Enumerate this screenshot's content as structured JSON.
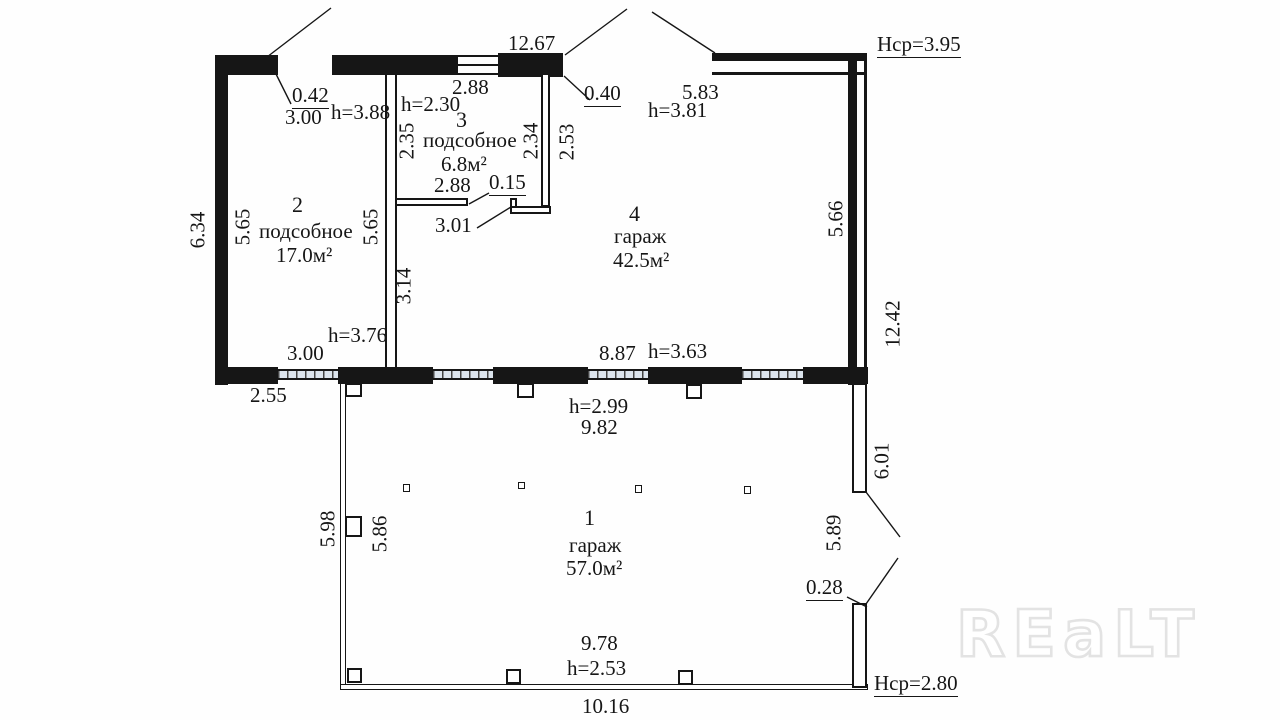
{
  "colors": {
    "line": "#161616",
    "window_fill": "#dce4ed",
    "watermark": "#e3e3e3"
  },
  "watermark": {
    "text": "REaLT"
  },
  "rooms": {
    "r1": {
      "number": "1",
      "name": "гараж",
      "area": "57.0м²"
    },
    "r2": {
      "number": "2",
      "name": "подсобное",
      "area": "17.0м²"
    },
    "r3": {
      "number": "3",
      "name": "подсобное",
      "area": "6.8м²"
    },
    "r4": {
      "number": "4",
      "name": "гараж",
      "area": "42.5м²"
    }
  },
  "heights": {
    "h_top_left": "h=3.88",
    "h_room3": "h=2.30",
    "h_room4": "h=3.81",
    "h_room2": "h=3.76",
    "h_mid_wall": "h=3.63",
    "h_room1_top": "h=2.99",
    "h_room1_bottom": "h=2.53",
    "avg_top": "Нср=3.95",
    "avg_bottom": "Нср=2.80"
  },
  "dims": {
    "top_opening": "12.67",
    "door_top_left": "0.42",
    "room2_width_top": "3.00",
    "room3_width_top": "2.88",
    "room3_left": "2.35",
    "room3_right": "2.34",
    "room4_notch": "2.53",
    "room3_width_bottom": "2.88",
    "step": "0.15",
    "wall_offset_top": "0.40",
    "room4_top": "5.83",
    "room4_inner_width": "3.01",
    "left_outer": "6.34",
    "room2_left": "5.65",
    "room2_right": "5.65",
    "room4_left_lower": "3.14",
    "room4_right": "5.66",
    "right_outer_top": "12.42",
    "room4_width_bottom": "8.87",
    "room2_width_bottom": "3.00",
    "left_ledge": "2.55",
    "room1_width_top": "9.82",
    "room1_left_outer": "5.98",
    "room1_left_inner": "5.86",
    "right_wall_upper": "6.01",
    "room1_right": "5.89",
    "right_jog": "0.28",
    "room1_width_bottom": "9.78",
    "bottom_outer": "10.16"
  }
}
